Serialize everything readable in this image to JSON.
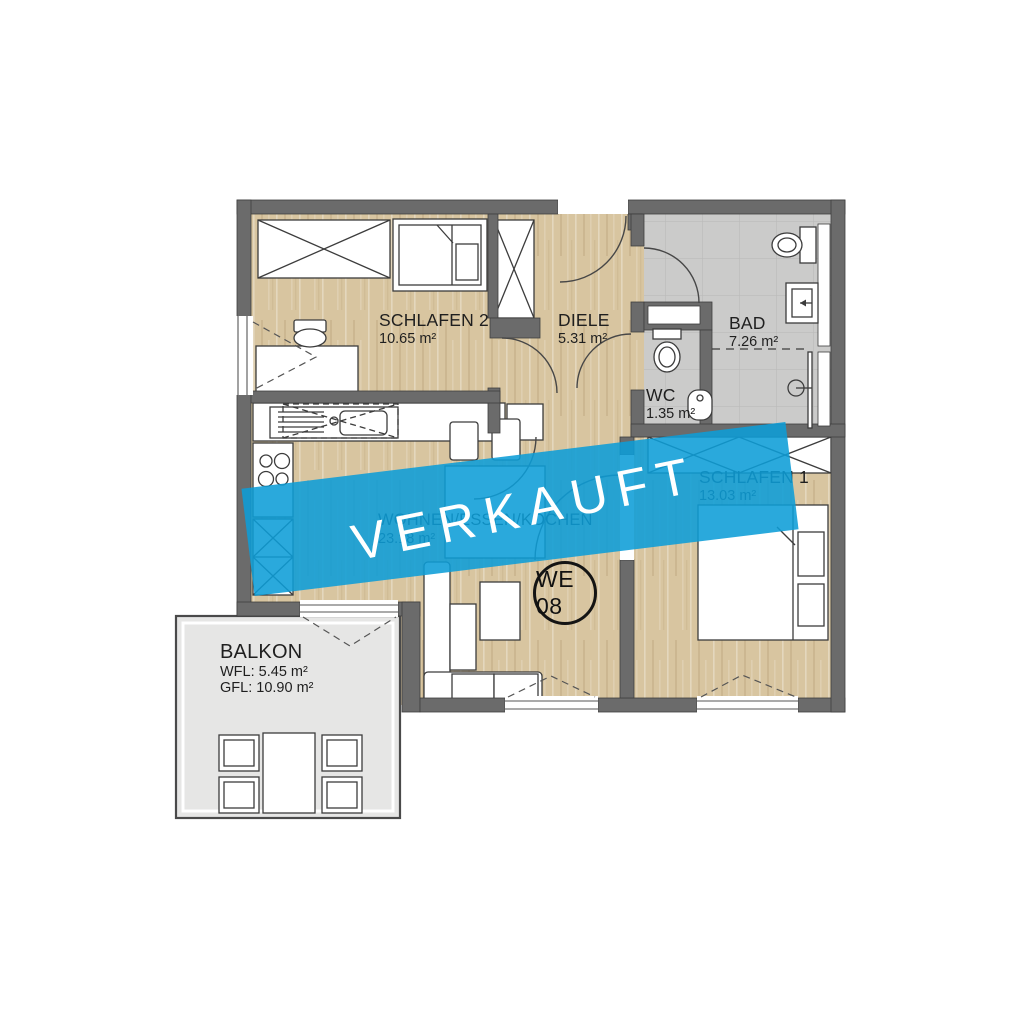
{
  "banner": {
    "label": "VERKAUFT"
  },
  "unit_badge": {
    "label": "WE 08"
  },
  "rooms": {
    "schlafen2": {
      "name": "SCHLAFEN 2",
      "area": "10.65 m²"
    },
    "diele": {
      "name": "DIELE",
      "area": "5.31 m²"
    },
    "bad": {
      "name": "BAD",
      "area": "7.26 m²"
    },
    "wc": {
      "name": "WC",
      "area": "1.35 m²"
    },
    "schlafen1": {
      "name": "SCHLAFEN 1",
      "area": "13.03 m²"
    },
    "wohnen": {
      "name": "WOHNEN/ESSEN/KOCHEN",
      "area": "23.18 m²"
    },
    "balkon": {
      "name": "BALKON",
      "wfl": "WFL: 5.45 m²",
      "gfl": "GFL: 10.90 m²"
    }
  },
  "colors": {
    "banner_blue": "#29A9DE",
    "banner_blue_overlay": "rgba(13,157,215,0.88)",
    "wall_grey": "#6B6B6B",
    "wood_floor": "#D8C5A0",
    "tile_grey": "#CBCBCA",
    "balcony_grey": "#E6E6E5"
  }
}
